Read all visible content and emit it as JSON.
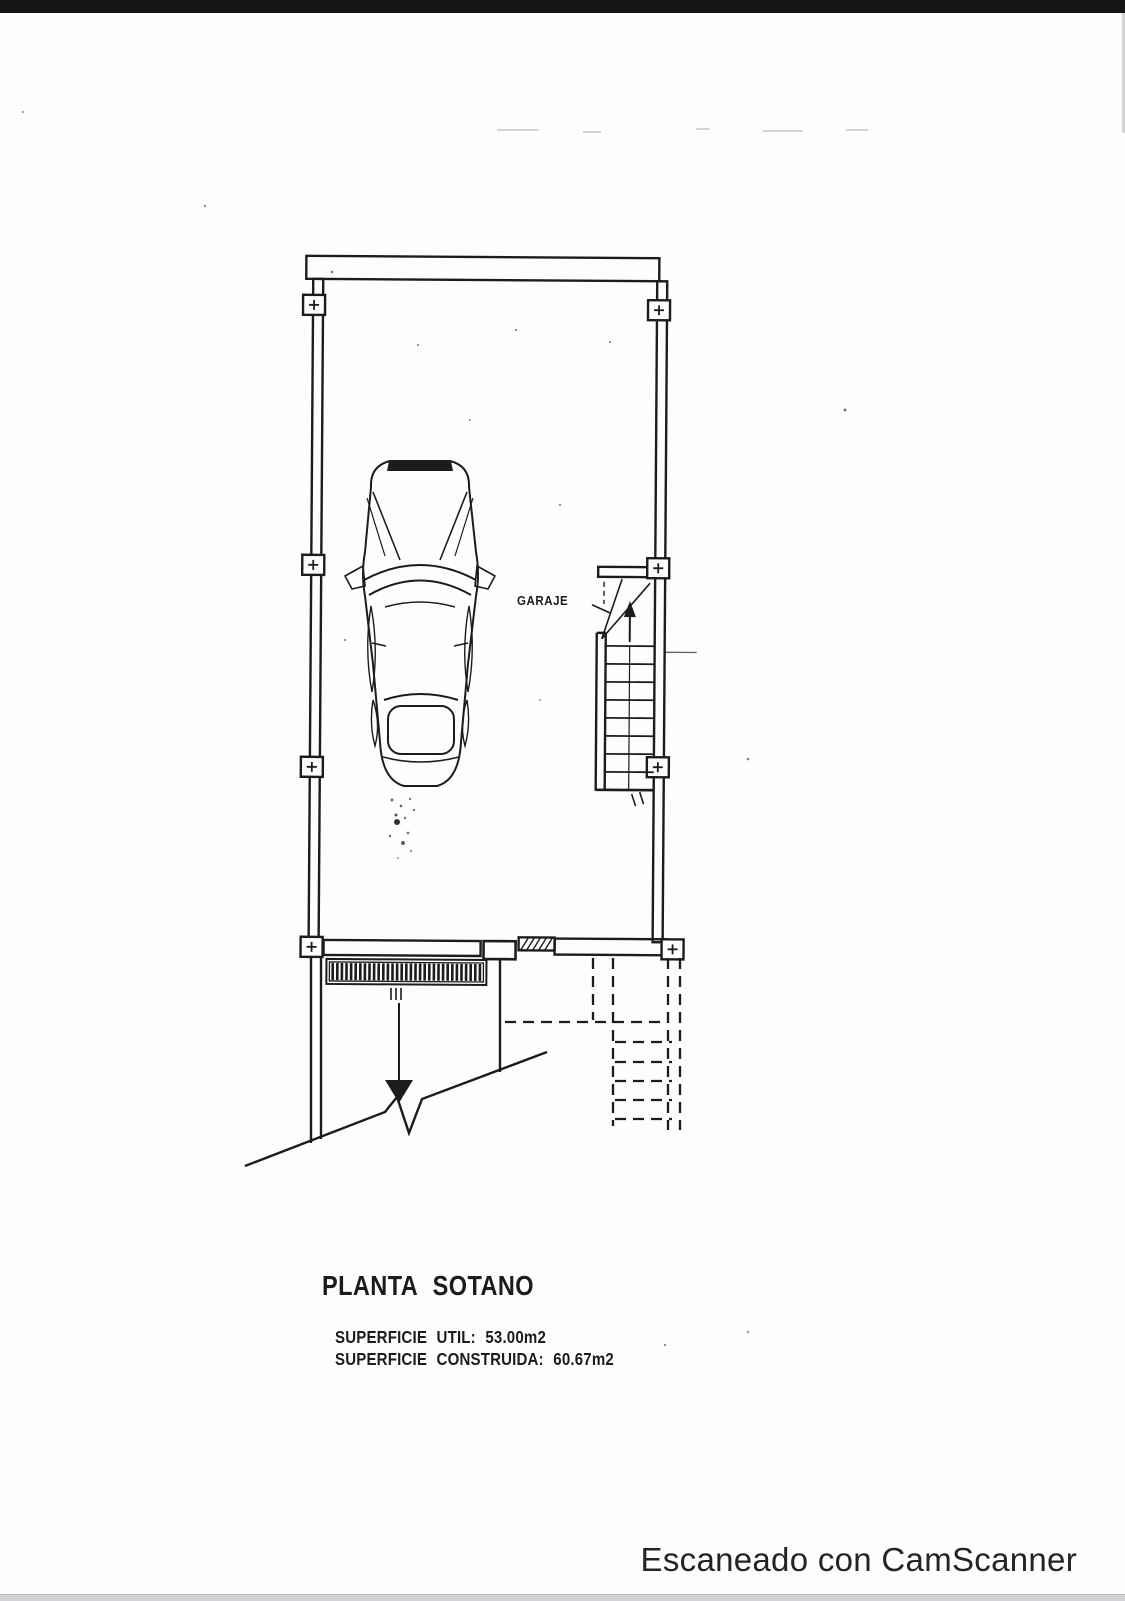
{
  "colors": {
    "paper": "#fdfdfc",
    "ink": "#1d1d1d",
    "top_bar": "#151515",
    "bottom_bar": "#d2d2d6",
    "watermark_text": "#242424"
  },
  "plan": {
    "room_label": "GARAJE",
    "title": "PLANTA SOTANO",
    "area_lines": [
      {
        "text": "SUPERFICIE UTIL: 53.00m2"
      },
      {
        "text": "SUPERFICIE CONSTRUIDA: 60.67m2"
      }
    ]
  },
  "footer": {
    "watermark": "Escaneado con CamScanner"
  }
}
